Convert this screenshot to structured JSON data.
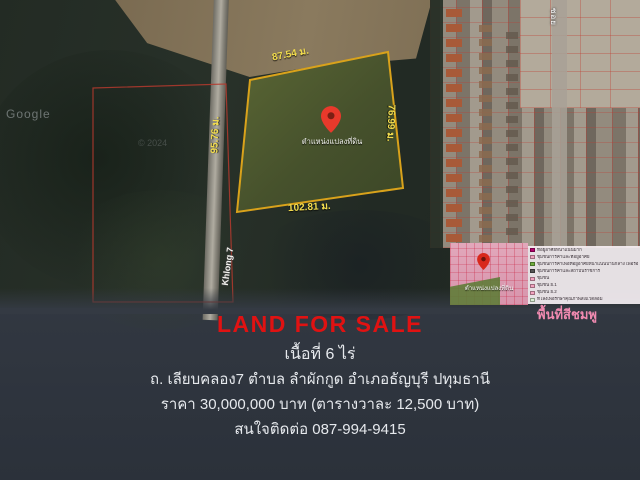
{
  "map": {
    "watermark": "Google",
    "copyright": "© 2024",
    "road_label": "Khlong 7",
    "soi_label": "ซอย",
    "pin_label": "ตำแหน่งแปลงที่ดิน",
    "measurements": {
      "top": "87.54 ม.",
      "right": "76.99 ม.",
      "bottom": "102.81 ม.",
      "left": "95.76 ม."
    },
    "colors": {
      "plot_outline": "#d9a21b",
      "plot_fill": "#4a5530",
      "survey_line": "#b53a2e",
      "measure_text": "#f2dc4e",
      "pin": "#e8392b"
    }
  },
  "inset": {
    "pin_label": "ตำแหน่งแปลงที่ดิน",
    "caption": "พื้นที่สีชมพู",
    "caption_color": "#f08ab0",
    "legend": [
      {
        "color": "#b5006e",
        "label": "ที่อยู่อาศัยหนาแน่นมาก"
      },
      {
        "color": "#f3a3c0",
        "label": "ชุมชนการค้าและที่อยู่อาศัย"
      },
      {
        "color": "#6fae3e",
        "label": "ชุมชนการค้าเพื่อที่อยู่อาศัยหนาแน่นปานกลาง เพื่อรองรับการขยายตัว"
      },
      {
        "color": "#555555",
        "label": "ชุมชนการค้าและสถาบันราชการ"
      },
      {
        "color": "#f3a3c0",
        "label": "ชุมชน"
      },
      {
        "color": "#f3a3c0",
        "label": "ชุมชน ย.1"
      },
      {
        "color": "#f3a3c0",
        "label": "ชุมชน ย.2"
      },
      {
        "color": "#d9eed2",
        "label": "ที่โล่งเพื่อรักษาคุณภาพสิ่งแวดล้อม"
      }
    ]
  },
  "listing": {
    "headline": "LAND FOR SALE",
    "headline_color": "#e01212",
    "area": "เนื้อที่ 6 ไร่",
    "address": "ถ. เลียบคลอง7 ตำบล ลำผักกูด อำเภอธัญบุรี ปทุมธานี",
    "price": "ราคา 30,000,000 บาท (ตารางวาละ 12,500 บาท)",
    "contact": "สนใจติดต่อ 087-994-9415"
  }
}
